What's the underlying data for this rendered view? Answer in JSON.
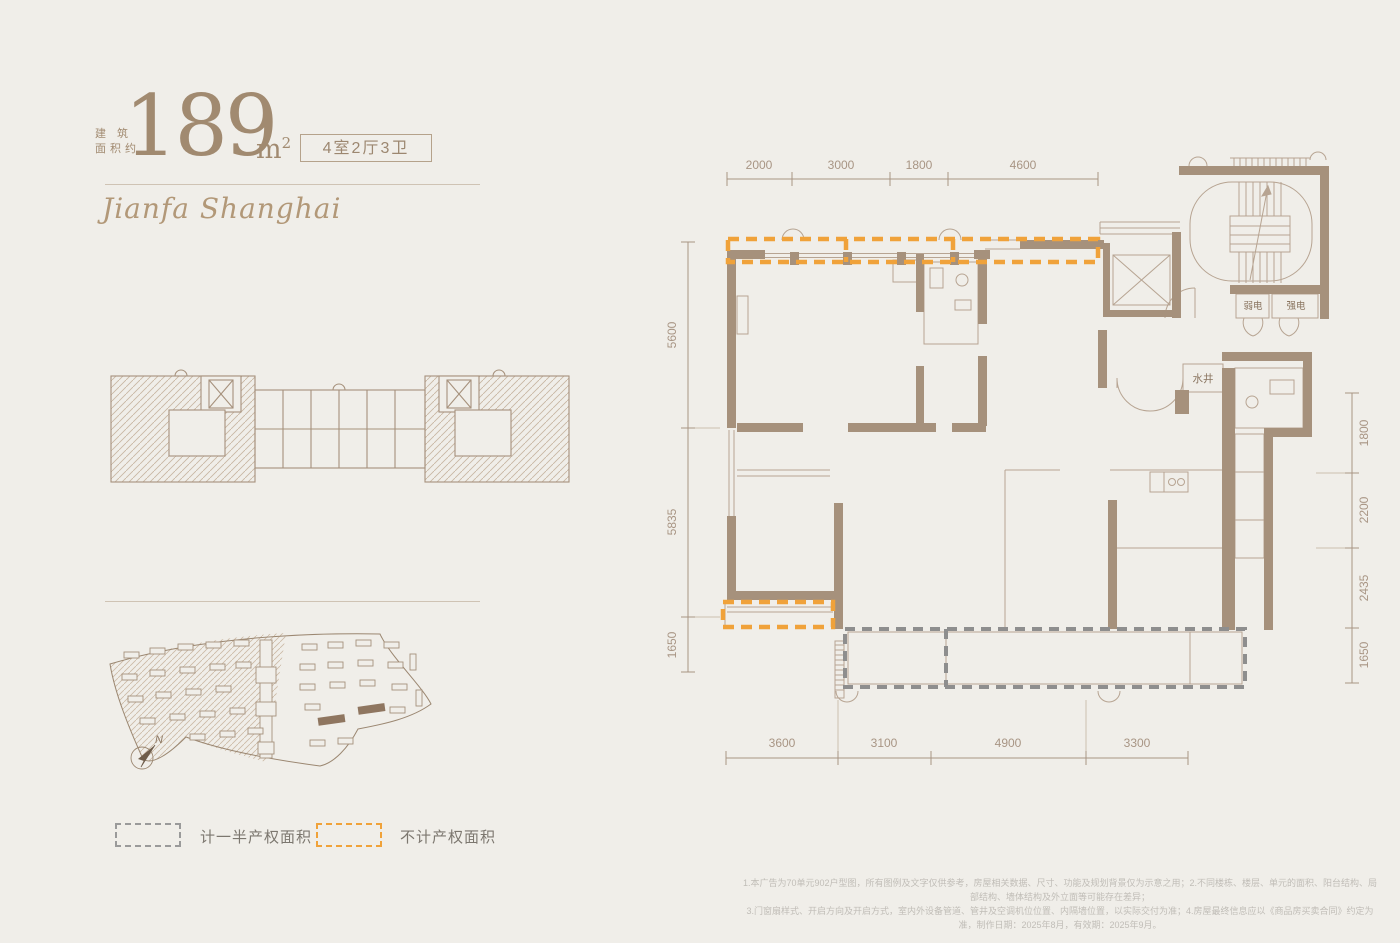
{
  "colors": {
    "background": "#f0eee9",
    "wall": "#a6917c",
    "thin_line": "#b7a492",
    "dimension": "#a89584",
    "title_brown": "#a18a70",
    "accent_orange": "#f0a23a",
    "dash_gray": "#8e8e8e"
  },
  "header": {
    "area_label_line1": "建 筑",
    "area_label_line2": "面积约",
    "area_value": "189",
    "area_unit": "m",
    "area_unit_sup": "2",
    "layout_badge": "4室2厅3卫",
    "brand": "Jianfa Shanghai"
  },
  "plan": {
    "rooms": {
      "weak_power": "弱电",
      "strong_power": "强电",
      "water_shaft": "水井"
    },
    "dims_top": [
      "2000",
      "3000",
      "1800",
      "4600"
    ],
    "dims_left": [
      "5600",
      "5835",
      "1650"
    ],
    "dims_right": [
      "1800",
      "2200",
      "2435",
      "1650"
    ],
    "dims_bottom": [
      "3600",
      "3100",
      "4900",
      "3300"
    ]
  },
  "legend": {
    "half_area": "计一半产权面积",
    "excluded_area": "不计产权面积"
  },
  "site": {
    "north": "N"
  },
  "footer": {
    "line1": "1.本广告为70单元902户型图，所有图例及文字仅供参考，房屋相关数据、尺寸、功能及规划背景仅为示意之用；2.不同楼栋、楼层、单元的面积、阳台结构、局部结构、墙体结构及外立面等可能存在差异；",
    "line2": "3.门窗扇样式、开启方向及开启方式，室内外设备管道、管井及空调机位位置、内隔墙位置，以实际交付为准；4.房屋最终信息应以《商品房买卖合同》约定为准，制作日期：2025年8月，有效期：2025年9月。"
  }
}
